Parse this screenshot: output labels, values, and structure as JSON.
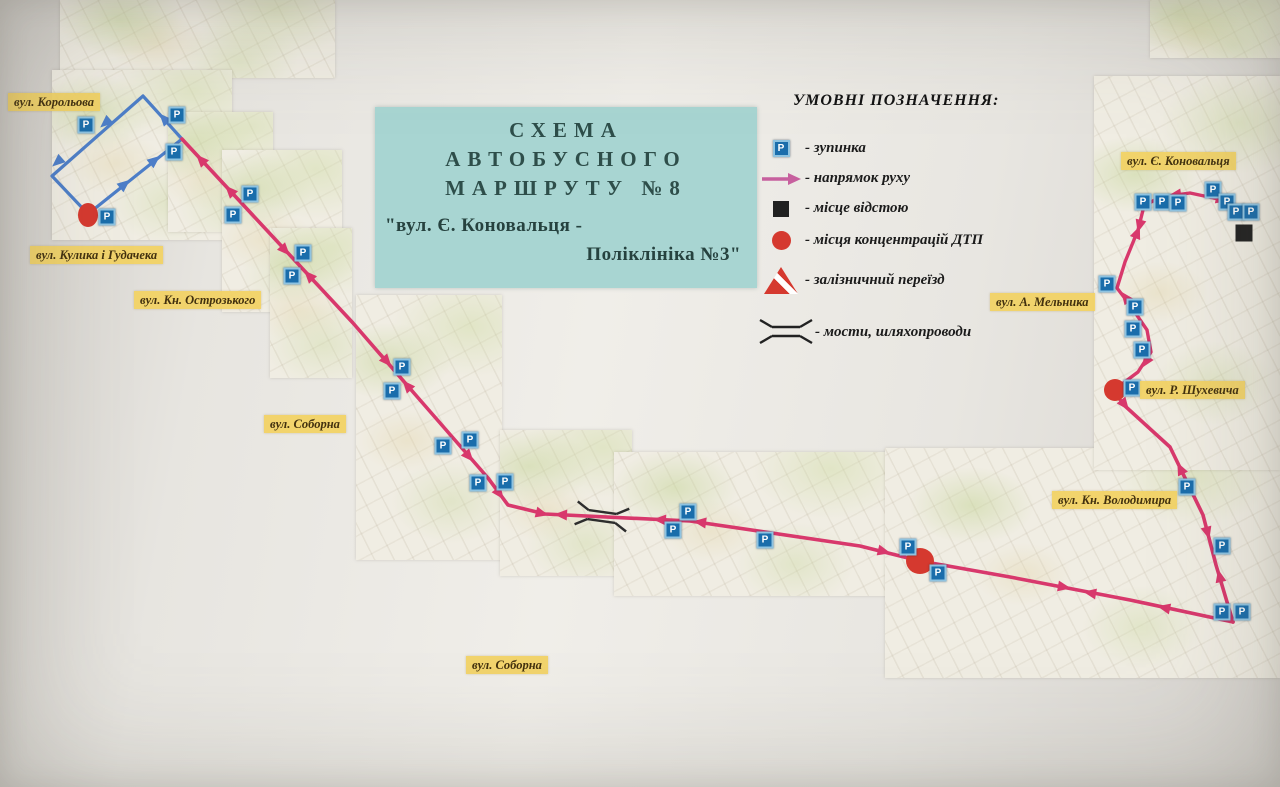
{
  "title_box": {
    "lines": [
      "СХЕМА",
      "АВТОБУСНОГО",
      "МАРШРУТУ  №8"
    ],
    "subtitle_line1": "\"вул. Є. Коновальця -",
    "subtitle_line2": "Поліклініка №3\""
  },
  "legend": {
    "title": "УМОВНІ ПОЗНАЧЕННЯ:",
    "items": [
      {
        "icon": "bus-stop",
        "label": "- зупинка"
      },
      {
        "icon": "direction-arrow",
        "label": "- напрямок руху"
      },
      {
        "icon": "layover",
        "label": "- місце відстою"
      },
      {
        "icon": "accident",
        "label": "- місця концентрацій ДТП"
      },
      {
        "icon": "railway-crossing",
        "label": "- залізничний переїзд"
      },
      {
        "icon": "bridge",
        "label": "- мости, шляхопроводи"
      }
    ]
  },
  "map": {
    "stop_glyph": "P",
    "colors": {
      "route": "#d8386c",
      "loop": "#4d7ec8",
      "legend_arrow": "#c7609e",
      "accident": "#d5392f",
      "layover": "#212121",
      "bridge": "#2d2d2d"
    },
    "street_labels": [
      {
        "text": "вул. Корольова",
        "x": 8,
        "y": 93
      },
      {
        "text": "вул. Кулика і Гудачека",
        "x": 30,
        "y": 246
      },
      {
        "text": "вул. Кн. Острозького",
        "x": 134,
        "y": 291
      },
      {
        "text": "вул. Соборна",
        "x": 264,
        "y": 415
      },
      {
        "text": "вул. Соборна",
        "x": 466,
        "y": 656
      },
      {
        "text": "вул. Є. Коновальця",
        "x": 1121,
        "y": 152
      },
      {
        "text": "вул. А. Мельника",
        "x": 990,
        "y": 293
      },
      {
        "text": "вул. Р. Шухевича",
        "x": 1140,
        "y": 381
      },
      {
        "text": "вул. Кн. Володимира",
        "x": 1052,
        "y": 491
      }
    ],
    "fragments": [
      {
        "x": 60,
        "y": 0,
        "w": 275,
        "h": 78
      },
      {
        "x": 52,
        "y": 70,
        "w": 180,
        "h": 170
      },
      {
        "x": 168,
        "y": 112,
        "w": 105,
        "h": 120
      },
      {
        "x": 222,
        "y": 150,
        "w": 120,
        "h": 162
      },
      {
        "x": 270,
        "y": 228,
        "w": 82,
        "h": 150
      },
      {
        "x": 356,
        "y": 295,
        "w": 146,
        "h": 265
      },
      {
        "x": 500,
        "y": 430,
        "w": 132,
        "h": 146
      },
      {
        "x": 614,
        "y": 452,
        "w": 278,
        "h": 144
      },
      {
        "x": 885,
        "y": 448,
        "w": 395,
        "h": 230
      },
      {
        "x": 1094,
        "y": 76,
        "w": 186,
        "h": 394
      },
      {
        "x": 1150,
        "y": 0,
        "w": 130,
        "h": 58
      }
    ],
    "routes": [
      {
        "name": "loop",
        "color": "loop",
        "width": 3.2,
        "points": [
          [
            143,
            96
          ],
          [
            52,
            176
          ],
          [
            88,
            214
          ],
          [
            182,
            139
          ],
          [
            143,
            96
          ]
        ]
      },
      {
        "name": "main",
        "color": "route",
        "width": 3.6,
        "points": [
          [
            182,
            139
          ],
          [
            353,
            323
          ],
          [
            420,
            400
          ],
          [
            488,
            478
          ],
          [
            508,
            505
          ],
          [
            545,
            514
          ],
          [
            690,
            521
          ],
          [
            860,
            546
          ],
          [
            920,
            561
          ],
          [
            1010,
            577
          ],
          [
            1130,
            600
          ],
          [
            1233,
            622
          ]
        ]
      },
      {
        "name": "volodymyra",
        "color": "route",
        "width": 3.6,
        "points": [
          [
            1233,
            622
          ],
          [
            1216,
            565
          ],
          [
            1203,
            515
          ],
          [
            1170,
            447
          ],
          [
            1125,
            406
          ],
          [
            1114,
            392
          ]
        ]
      },
      {
        "name": "melnyka",
        "color": "route",
        "width": 3.4,
        "points": [
          [
            1114,
            390
          ],
          [
            1138,
            372
          ],
          [
            1151,
            352
          ],
          [
            1147,
            330
          ],
          [
            1130,
            305
          ],
          [
            1117,
            288
          ],
          [
            1125,
            262
          ],
          [
            1138,
            230
          ],
          [
            1144,
            206
          ]
        ]
      },
      {
        "name": "konovaltsia",
        "color": "route",
        "width": 3.4,
        "points": [
          [
            1144,
            206
          ],
          [
            1160,
            197
          ],
          [
            1190,
            193
          ],
          [
            1223,
            200
          ],
          [
            1233,
            206
          ]
        ]
      }
    ],
    "arrows": [
      {
        "x": 110,
        "y": 119,
        "r": 139,
        "c": "loop"
      },
      {
        "x": 62,
        "y": 158,
        "r": 139,
        "c": "loop"
      },
      {
        "x": 120,
        "y": 188,
        "r": -39,
        "c": "loop"
      },
      {
        "x": 150,
        "y": 164,
        "r": -39,
        "c": "loop"
      },
      {
        "x": 168,
        "y": 123,
        "r": -132,
        "c": "loop"
      },
      {
        "x": 205,
        "y": 164,
        "r": -133
      },
      {
        "x": 234,
        "y": 195,
        "r": -133
      },
      {
        "x": 281,
        "y": 246,
        "r": 47
      },
      {
        "x": 313,
        "y": 280,
        "r": -133
      },
      {
        "x": 383,
        "y": 357,
        "r": 49
      },
      {
        "x": 411,
        "y": 390,
        "r": -131
      },
      {
        "x": 465,
        "y": 452,
        "r": 49
      },
      {
        "x": 496,
        "y": 489,
        "r": 53
      },
      {
        "x": 536,
        "y": 512,
        "r": 14
      },
      {
        "x": 567,
        "y": 515,
        "r": 183
      },
      {
        "x": 666,
        "y": 520,
        "r": 183
      },
      {
        "x": 706,
        "y": 523,
        "r": 188
      },
      {
        "x": 878,
        "y": 550,
        "r": 14
      },
      {
        "x": 1058,
        "y": 586,
        "r": 10
      },
      {
        "x": 1096,
        "y": 594,
        "r": 190
      },
      {
        "x": 1170,
        "y": 609,
        "r": 192
      },
      {
        "x": 1221,
        "y": 582,
        "r": -103
      },
      {
        "x": 1206,
        "y": 527,
        "r": 75
      },
      {
        "x": 1183,
        "y": 474,
        "r": -116
      },
      {
        "x": 1121,
        "y": 400,
        "r": 52
      },
      {
        "x": 1149,
        "y": 357,
        "r": 123
      },
      {
        "x": 1129,
        "y": 302,
        "r": -127
      },
      {
        "x": 1135,
        "y": 238,
        "r": -68
      },
      {
        "x": 1141,
        "y": 220,
        "r": 105
      },
      {
        "x": 1181,
        "y": 194,
        "r": 172
      },
      {
        "x": 1216,
        "y": 198,
        "r": 12
      }
    ],
    "stops": [
      [
        86,
        125
      ],
      [
        177,
        115
      ],
      [
        174,
        152
      ],
      [
        107,
        217
      ],
      [
        250,
        194
      ],
      [
        233,
        215
      ],
      [
        303,
        253
      ],
      [
        292,
        276
      ],
      [
        402,
        367
      ],
      [
        392,
        391
      ],
      [
        443,
        446
      ],
      [
        470,
        440
      ],
      [
        478,
        483
      ],
      [
        505,
        482
      ],
      [
        688,
        512
      ],
      [
        673,
        530
      ],
      [
        765,
        540
      ],
      [
        908,
        547
      ],
      [
        938,
        573
      ],
      [
        1187,
        487
      ],
      [
        1222,
        546
      ],
      [
        1222,
        612
      ],
      [
        1242,
        612
      ],
      [
        1132,
        388
      ],
      [
        1142,
        350
      ],
      [
        1133,
        329
      ],
      [
        1135,
        307
      ],
      [
        1107,
        284
      ],
      [
        1143,
        202
      ],
      [
        1162,
        202
      ],
      [
        1178,
        203
      ],
      [
        1213,
        190
      ],
      [
        1227,
        202
      ],
      [
        1236,
        212
      ],
      [
        1251,
        212
      ]
    ],
    "accidents": [
      [
        88,
        215,
        10,
        12
      ],
      [
        920,
        561,
        14,
        13
      ],
      [
        1115,
        390,
        11,
        11
      ]
    ],
    "layover": {
      "x": 1244,
      "y": 233,
      "size": 17
    },
    "bridge": {
      "x": 602,
      "y": 516,
      "angle": 8
    }
  }
}
